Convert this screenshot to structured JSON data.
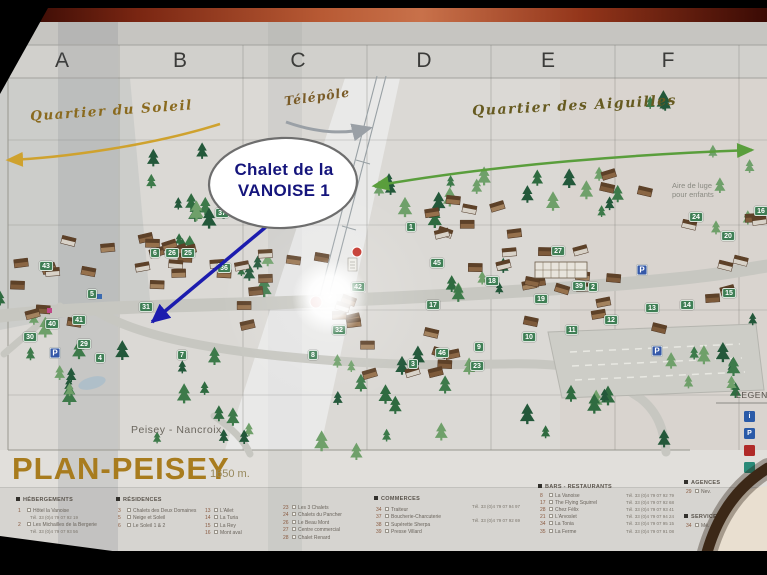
{
  "map": {
    "columns": [
      "A",
      "B",
      "C",
      "D",
      "E",
      "F"
    ],
    "labels": {
      "quartier_soleil": "Quartier du Soleil",
      "telepole": "Télépôle",
      "quartier_aiguilles": "Quartier des Aiguilles",
      "aire_luge_line1": "Aire de luge",
      "aire_luge_line2": "pour enfants",
      "peisey_nancroix": "Peisey - Nancroix"
    },
    "callout": {
      "line1": "Chalet de la",
      "line2": "VANOISE  1",
      "text_color": "#15157c",
      "arrow_color": "#1c1cae"
    },
    "parking_label": "P",
    "badge_color": "#3e7e54",
    "badges": [
      {
        "n": "43",
        "x": 46,
        "y": 266
      },
      {
        "n": "6",
        "x": 155,
        "y": 253
      },
      {
        "n": "26",
        "x": 172,
        "y": 253
      },
      {
        "n": "25",
        "x": 188,
        "y": 253
      },
      {
        "n": "37",
        "x": 222,
        "y": 213
      },
      {
        "n": "36",
        "x": 224,
        "y": 268
      },
      {
        "n": "5",
        "x": 92,
        "y": 294
      },
      {
        "n": "31",
        "x": 146,
        "y": 307
      },
      {
        "n": "40",
        "x": 52,
        "y": 324
      },
      {
        "n": "41",
        "x": 79,
        "y": 320
      },
      {
        "n": "30",
        "x": 30,
        "y": 337
      },
      {
        "n": "29",
        "x": 84,
        "y": 344
      },
      {
        "n": "4",
        "x": 100,
        "y": 358
      },
      {
        "n": "7",
        "x": 182,
        "y": 355
      },
      {
        "n": "1",
        "x": 411,
        "y": 227
      },
      {
        "n": "45",
        "x": 437,
        "y": 263
      },
      {
        "n": "18",
        "x": 492,
        "y": 281
      },
      {
        "n": "42",
        "x": 358,
        "y": 287
      },
      {
        "n": "17",
        "x": 433,
        "y": 305
      },
      {
        "n": "32",
        "x": 339,
        "y": 330
      },
      {
        "n": "8",
        "x": 313,
        "y": 355
      },
      {
        "n": "3",
        "x": 413,
        "y": 364
      },
      {
        "n": "46",
        "x": 442,
        "y": 353
      },
      {
        "n": "9",
        "x": 479,
        "y": 347
      },
      {
        "n": "23",
        "x": 477,
        "y": 366
      },
      {
        "n": "27",
        "x": 558,
        "y": 251
      },
      {
        "n": "39",
        "x": 579,
        "y": 286
      },
      {
        "n": "2",
        "x": 593,
        "y": 287
      },
      {
        "n": "19",
        "x": 541,
        "y": 299
      },
      {
        "n": "15",
        "x": 729,
        "y": 293
      },
      {
        "n": "13",
        "x": 652,
        "y": 308
      },
      {
        "n": "14",
        "x": 687,
        "y": 305
      },
      {
        "n": "12",
        "x": 611,
        "y": 320
      },
      {
        "n": "11",
        "x": 572,
        "y": 330
      },
      {
        "n": "10",
        "x": 529,
        "y": 337
      },
      {
        "n": "24",
        "x": 696,
        "y": 217
      },
      {
        "n": "20",
        "x": 728,
        "y": 236
      },
      {
        "n": "16",
        "x": 761,
        "y": 211
      }
    ],
    "parkings": [
      {
        "x": 55,
        "y": 353
      },
      {
        "x": 642,
        "y": 270
      },
      {
        "x": 657,
        "y": 351
      }
    ],
    "legend_box": {
      "title": "LEGENDE",
      "icons": [
        {
          "name": "info-icon",
          "color": "#2a5aa8",
          "glyph": "i"
        },
        {
          "name": "parking-icon",
          "color": "#2a5aa8",
          "glyph": "P"
        },
        {
          "name": "secours-icon",
          "color": "#b02a28",
          "glyph": ""
        },
        {
          "name": "navette-icon",
          "color": "#2a8a78",
          "glyph": ""
        }
      ]
    }
  },
  "title": {
    "name": "PLAN-PEISEY",
    "altitude": "1650 m."
  },
  "legend": {
    "sections": [
      {
        "title": "HÉBERGEMENTS",
        "items": [
          {
            "n": "1",
            "label": "Hôtel la Vanoise",
            "tel": "Tél. 33 (0)4 79 07 92 19"
          },
          {
            "n": "2",
            "label": "Les Michailles de la Bergerie",
            "tel": "Tél. 33 (0)4 79 07 93 56"
          }
        ]
      },
      {
        "title": "RÉSIDENCES",
        "items": [
          {
            "n": "3",
            "label": "Chalets des Deux Domaines"
          },
          {
            "n": "5",
            "label": "Neige et Soleil"
          },
          {
            "n": "6",
            "label": "Le Soleil 1 & 2"
          }
        ]
      },
      {
        "title": "",
        "items": [
          {
            "n": "13",
            "label": "L'Ailet"
          },
          {
            "n": "14",
            "label": "La Turia"
          },
          {
            "n": "15",
            "label": "La Rey"
          },
          {
            "n": "16",
            "label": "Mont aval"
          }
        ]
      },
      {
        "title": "",
        "items": [
          {
            "n": "23",
            "label": "Les 3 Chalets"
          },
          {
            "n": "24",
            "label": "Chalets du Pancher"
          },
          {
            "n": "26",
            "label": "Le Beau Mont"
          },
          {
            "n": "27",
            "label": "Centre commercial"
          },
          {
            "n": "28",
            "label": "Chalet Renard"
          }
        ]
      },
      {
        "title": "COMMERCES",
        "items": [
          {
            "n": "34",
            "label": "Traiteur"
          },
          {
            "n": "37",
            "label": "Boucherie-Charcuterie"
          },
          {
            "n": "38",
            "label": "Supérette Sherpa"
          },
          {
            "n": "39",
            "label": "Presse Villard"
          }
        ],
        "tels": [
          "Tél. 33 (0)4 79 07 94 97",
          "Tél. 33 (0)4 79 07 92 69"
        ]
      },
      {
        "title": "BARS - RESTAURANTS",
        "items": [
          {
            "n": "8",
            "label": "La Vanoise",
            "tel": "Tél. 33 (0)4 79 07 92 79"
          },
          {
            "n": "17",
            "label": "The Flying Squirrel",
            "tel": "Tél. 33 (0)4 79 07 92 68"
          },
          {
            "n": "28",
            "label": "Chez Félix",
            "tel": "Tél. 33 (0)4 79 07 93 41"
          },
          {
            "n": "21",
            "label": "L'Arvoslet",
            "tel": "Tél. 33 (0)4 79 07 94 24"
          },
          {
            "n": "34",
            "label": "La Tonia",
            "tel": "Tél. 33 (0)4 79 07 95 15"
          },
          {
            "n": "35",
            "label": "La Ferme",
            "tel": "Tél. 33 (0)4 79 07 91 08"
          }
        ]
      },
      {
        "title": "AGENCES",
        "items": [
          {
            "n": "29",
            "label": "Nev."
          }
        ]
      },
      {
        "title": "SERVICES",
        "items": [
          {
            "n": "34",
            "label": "Mé."
          }
        ]
      }
    ]
  }
}
